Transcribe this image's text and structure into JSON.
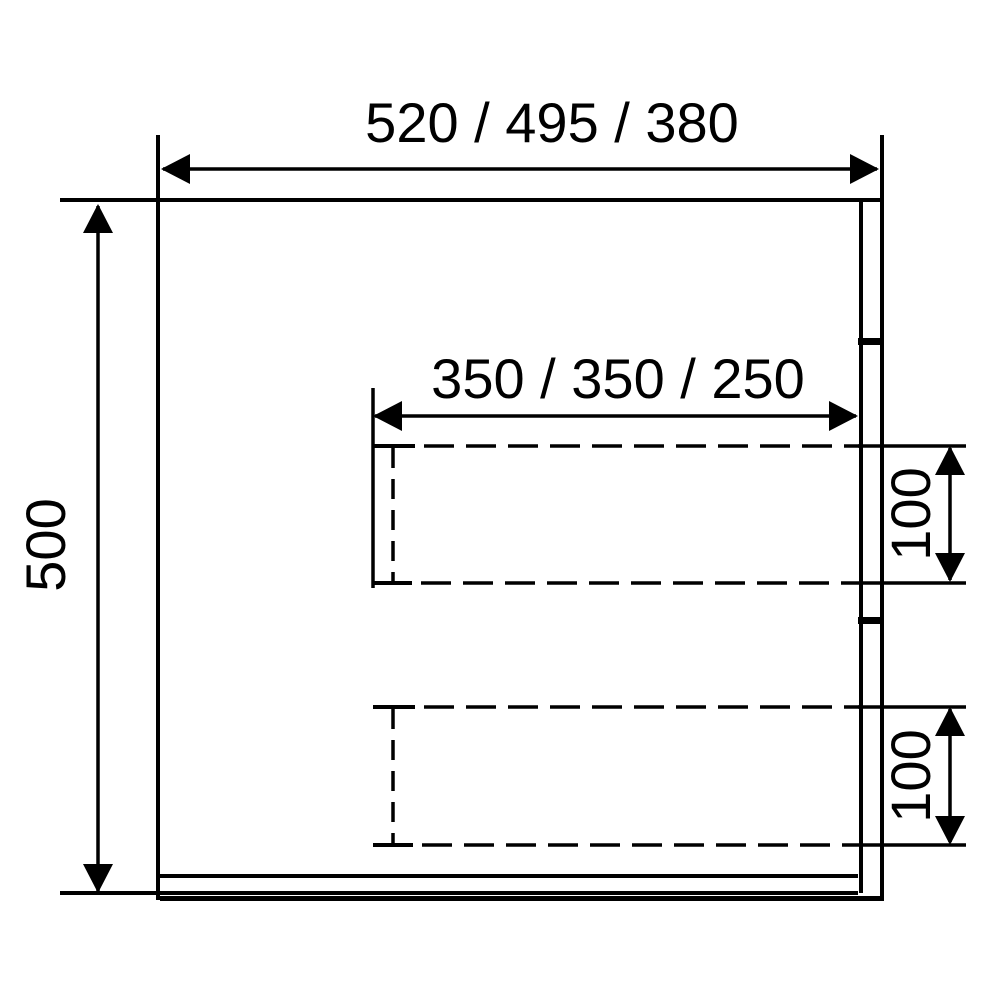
{
  "drawing": {
    "dimension_labels": {
      "overall_width": "520 / 495 / 380",
      "overall_height": "500",
      "recess_width": "350 / 350 / 250",
      "upper_recess_height": "100",
      "lower_recess_height": "100"
    },
    "line_color": "#000000",
    "background_color": "#ffffff"
  }
}
